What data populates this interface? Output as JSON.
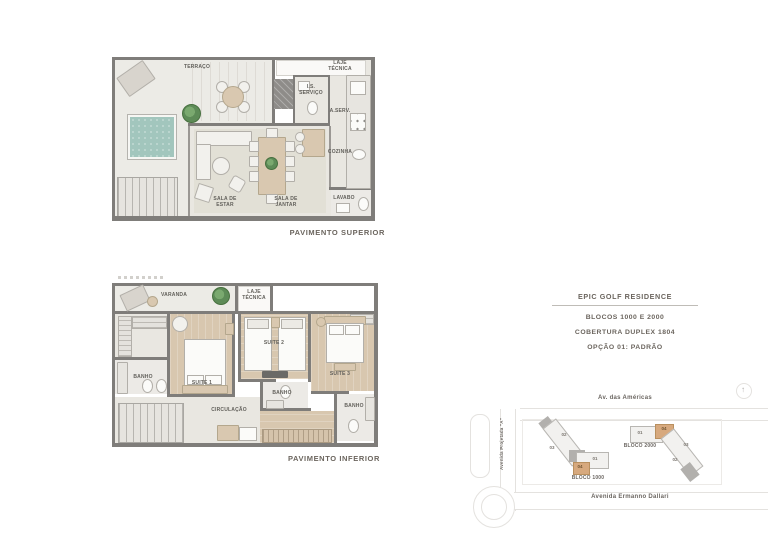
{
  "colors": {
    "wall": "#7f7d7a",
    "pool": "#a2c6bd",
    "wood": "#d8c7af",
    "tan": "#d9c8b0",
    "plant": "#5d8b57",
    "label_text": "#62605b",
    "heading_text": "#6b655e",
    "road_line": "#e4e2df",
    "building_fill": "#f2f1ef",
    "building_dark": "#b2b0ad",
    "highlight": "#d7a97e"
  },
  "plan_superior": {
    "caption": "PAVIMENTO SUPERIOR",
    "rooms": {
      "terraco": "TERRAÇO",
      "laje_tecnica": "LAJE\nTÉCNICA",
      "is_servico": "I.S.\nSERVIÇO",
      "area_servico": "A.SERV.",
      "cozinha": "COZINHA",
      "sala_de_estar": "SALA DE\nESTAR",
      "sala_de_jantar": "SALA DE\nJANTAR",
      "lavabo": "LAVABO"
    }
  },
  "plan_inferior": {
    "caption": "PAVIMENTO INFERIOR",
    "rooms": {
      "varanda": "VARANDA",
      "laje_tecnica": "LAJE\nTÉCNICA",
      "suite_1": "SUITE 1",
      "suite_2": "SUITE 2",
      "suite_3": "SUITE 3",
      "banho_1": "BANHO",
      "banho_2": "BANHO",
      "banho_3": "BANHO",
      "circulacao": "CIRCULAÇÃO"
    }
  },
  "info_panel": {
    "title": "EPIC GOLF RESIDENCE",
    "subtitle_1": "BLOCOS 1000 E 2000",
    "subtitle_2": "COBERTURA DUPLEX 1804",
    "subtitle_3": "OPÇÃO 01: PADRÃO"
  },
  "site_map": {
    "street_top": "Av. das Américas",
    "street_left": "Avenida Projetada \"A\"",
    "street_bottom": "Avenida Ermanno Dallari",
    "bloco_1000": {
      "label": "BLOCO 1000",
      "units": [
        "01",
        "02",
        "03",
        "04"
      ],
      "highlighted_unit": "04"
    },
    "bloco_2000": {
      "label": "BLOCO 2000",
      "units": [
        "01",
        "02",
        "03",
        "04"
      ],
      "highlighted_unit": "04"
    }
  }
}
